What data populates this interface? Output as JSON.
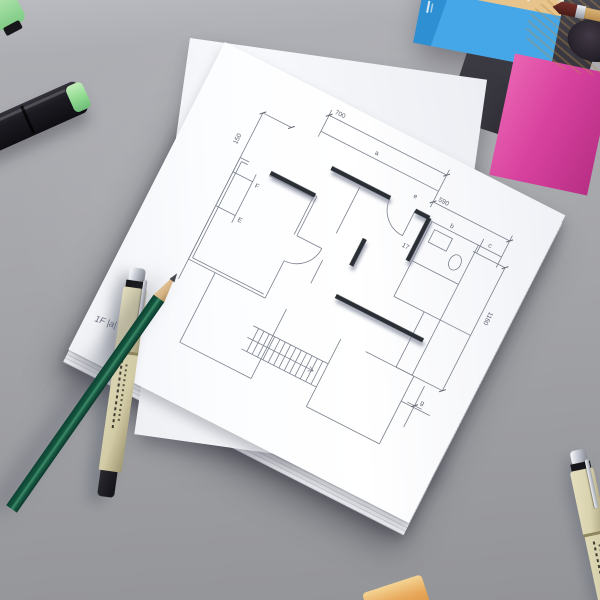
{
  "floor_plan": {
    "scale_note": "1F |a| 1:100",
    "dimensions": {
      "left_height": "150",
      "top_main": "700",
      "top_right": "590",
      "right_side": "1160"
    },
    "labels": {
      "a": "a",
      "b": "b",
      "c": "c",
      "e": "e",
      "g": "g",
      "F": "F",
      "E": "E",
      "door": "17"
    }
  },
  "colors": {
    "desk_gray": "#a6a7ab",
    "paper_white": "#fdfdff",
    "plan_thin_line": "#7b808c",
    "plan_wall_dark": "#2c2e35",
    "label_ink": "#5a5f6d",
    "marker_black": "#1b1a1f",
    "marker_cap_green": "#8fd98f",
    "pen_cream": "#d8d2ae",
    "pencil_green": "#14523f",
    "pencil_wood": "#d9b98c",
    "pot_blue": "#45a7e8",
    "pot_pink": "#d8429f",
    "wood_tan": "#e7c48b",
    "brush_maroon": "#5e2320",
    "eraser_orange": "#e6a455"
  }
}
